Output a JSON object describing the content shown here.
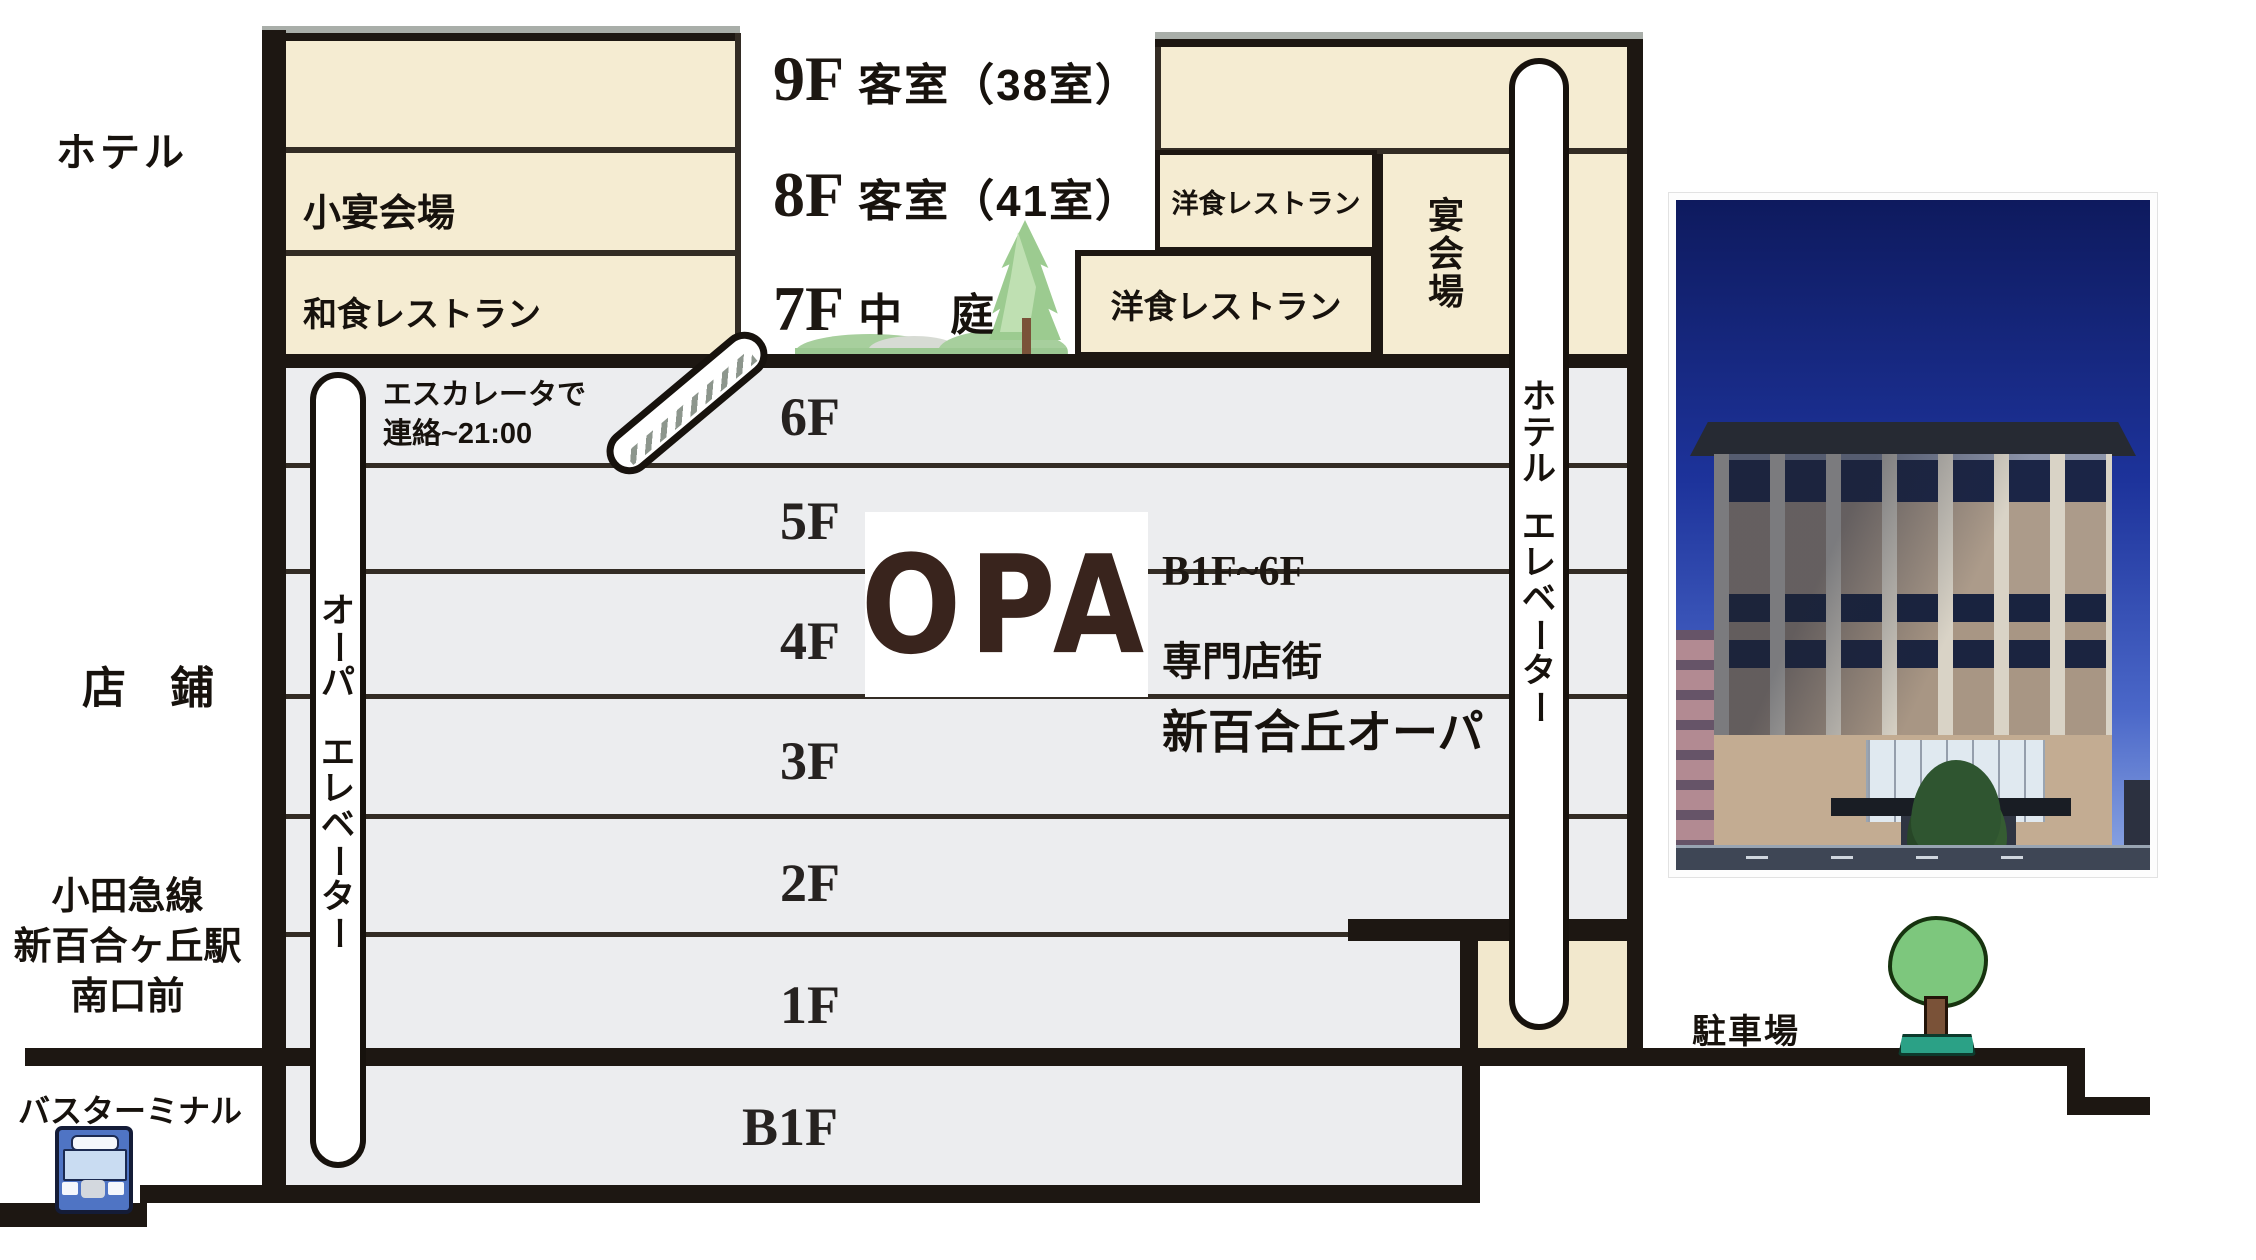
{
  "title": "新百合丘オーパ ビル断面フロア案内図",
  "left_labels": {
    "hotel": "ホテル",
    "shops": "店　鋪",
    "station_line1": "小田急線",
    "station_line2": "新百合ヶ丘駅",
    "station_line3": "南口前",
    "bus_terminal": "バスターミナル"
  },
  "hotel": {
    "floor9_num": "9F",
    "floor9_label": "客室（38室）",
    "floor8_num": "8F",
    "floor8_label": "客室（41室）",
    "floor7_num": "7F",
    "floor7_label": "中　庭",
    "small_banquet": "小宴会場",
    "japanese_restaurant": "和食レストラン",
    "western_restaurant_8f": "洋食レストラン",
    "western_restaurant_7f": "洋食レストラン",
    "banquet_hall": "宴会場",
    "elevator_line1": "ホテル",
    "elevator_line2": "エレベーター"
  },
  "escalator": {
    "line1": "エスカレータで",
    "line2": "連絡~21:00"
  },
  "floors": {
    "f6": "6F",
    "f5": "5F",
    "f4": "4F",
    "f3": "3F",
    "f2": "2F",
    "f1": "1F",
    "b1": "B1F"
  },
  "opa": {
    "logo": "OPA",
    "range": "B1F~6F",
    "type": "専門店街",
    "name": "新百合丘オーパ",
    "elevator_line1": "オーパ",
    "elevator_line2": "エレベーター"
  },
  "parking": {
    "label": "駐車場"
  },
  "colors": {
    "cream": "#f5ecd2",
    "floor_band": "#ecedef",
    "line_dark": "#1d1712",
    "opa_brown": "#39241d",
    "bus_blue": "#4f74c4",
    "garden_green": "#9ccb90",
    "tree_base_teal": "#2ba186",
    "photo_sky": "#1d339b"
  }
}
